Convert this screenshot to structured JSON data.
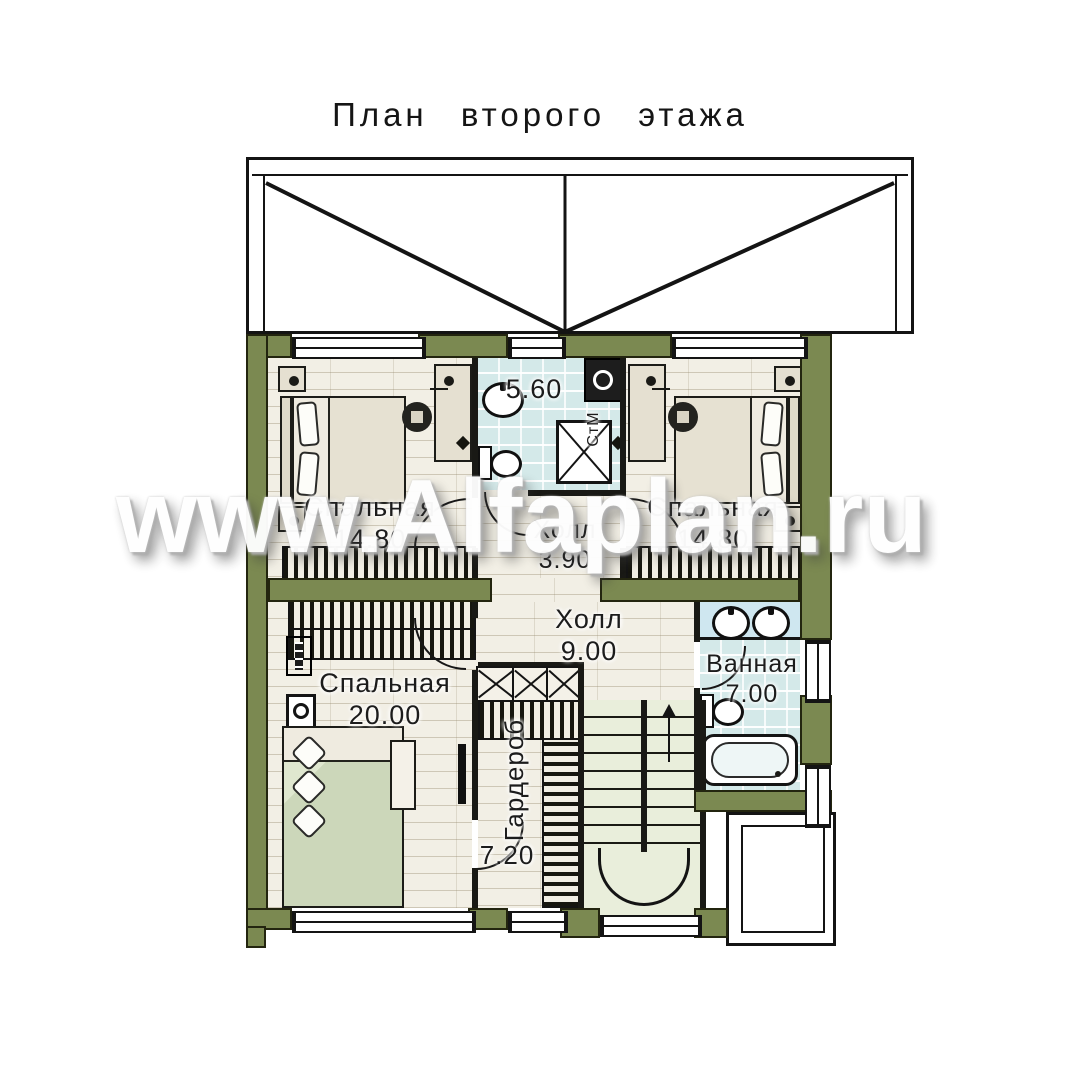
{
  "title": "План второго этажа",
  "watermark": "www.Alfaplan.ru",
  "rooms": {
    "bedroom_top_left": {
      "name": "Спальная",
      "area": "14.80"
    },
    "bedroom_top_right": {
      "name": "Спальная",
      "area": "14.80"
    },
    "bathroom_top": {
      "area": "5.60"
    },
    "washing_machine": {
      "label": "СтМ"
    },
    "hall_small": {
      "name": "Холл",
      "area": "3.90"
    },
    "hall_main": {
      "name": "Холл",
      "area": "9.00"
    },
    "bedroom_large": {
      "name": "Спальная",
      "area": "20.00"
    },
    "wardrobe": {
      "name": "Гардероб",
      "area": "7.20"
    },
    "bathroom_right": {
      "name": "Ванная",
      "area": "7.00"
    }
  },
  "stairs": {
    "direction": "up"
  },
  "colors": {
    "wall_olive": "#7b8951",
    "floor_wood": "#f2efe5",
    "floor_tile": "#d4e9e9",
    "stair_fill": "#e9eedb",
    "line": "#141414",
    "watermark_white": "#fefefe"
  }
}
